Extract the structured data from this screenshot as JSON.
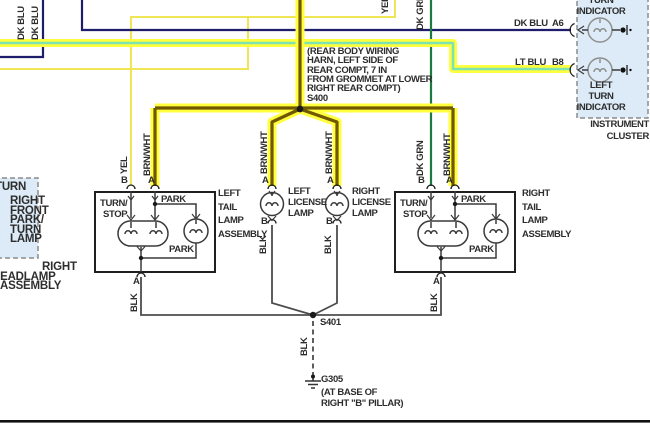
{
  "colors": {
    "highlight_yellow": "#ffff3d",
    "brnwht_core": "#6f5800",
    "ltblu_core": "#7de3b0",
    "dk_blu": "#1d1d6b",
    "dk_grn": "#1f7a40",
    "yel": "#f0e655",
    "blk": "#4d4d4d",
    "box_fill": "#dcebf7"
  },
  "top": {
    "dkblu1": "DK BLU",
    "dkblu2": "DK BLU",
    "yel": "YEL",
    "dkgrn": "DK GRN",
    "dkblu_label": "DK BLU",
    "dkblu_pin": "A6",
    "ltblu_label": "LT BLU",
    "ltblu_pin": "B8"
  },
  "cluster": {
    "rt1": "TURN",
    "rt2": "INDICATOR",
    "lt1": "LEFT",
    "lt2": "TURN",
    "lt3": "INDICATOR",
    "cap1": "INSTRUMENT",
    "cap2": "CLUSTER"
  },
  "s400": {
    "l1": "(REAR BODY WIRING",
    "l2": "HARN, LEFT SIDE OF",
    "l3": "REAR COMPT, 7 IN",
    "l4": "FROM GROMMET AT LOWER",
    "l5": "RIGHT REAR COMPT)",
    "name": "S400"
  },
  "headlamp": {
    "top_label": "TURN",
    "b1": "RIGHT",
    "b2": "FRONT",
    "b3": "PARK/",
    "b4": "TURN",
    "b5": "LAMP",
    "c1": "RIGHT",
    "c2": "HEADLAMP",
    "c3": "ASSEMBLY"
  },
  "left_tail": {
    "pin_b": "B",
    "wire_b": "YEL",
    "pin_a": "A",
    "wire_a": "BRN/WHT",
    "turn1": "TURN/",
    "turn2": "STOP",
    "park_top": "PARK",
    "park_bot": "PARK",
    "pin_gnd": "A",
    "wire_gnd": "BLK",
    "c1": "LEFT",
    "c2": "TAIL",
    "c3": "LAMP",
    "c4": "ASSEMBLY"
  },
  "right_tail": {
    "pin_b": "B",
    "wire_b": "DK GRN",
    "pin_a": "A",
    "wire_a": "BRN/WHT",
    "turn1": "TURN/",
    "turn2": "STOP",
    "park_top": "PARK",
    "park_bot": "PARK",
    "pin_gnd": "A",
    "wire_gnd": "BLK",
    "c1": "RIGHT",
    "c2": "TAIL",
    "c3": "LAMP",
    "c4": "ASSEMBLY"
  },
  "left_lic": {
    "pin_a": "A",
    "wire_a": "BRN/WHT",
    "pin_b": "B",
    "wire_gnd": "BLK",
    "c1": "LEFT",
    "c2": "LICENSE",
    "c3": "LAMP"
  },
  "right_lic": {
    "pin_a": "A",
    "wire_a": "BRN/WHT",
    "pin_b": "B",
    "wire_gnd": "BLK",
    "c1": "RIGHT",
    "c2": "LICENSE",
    "c3": "LAMP"
  },
  "ground": {
    "s401": "S401",
    "wire": "BLK",
    "g305": "G305",
    "n1": "(AT BASE OF",
    "n2": "RIGHT \"B\" PILLAR)"
  }
}
